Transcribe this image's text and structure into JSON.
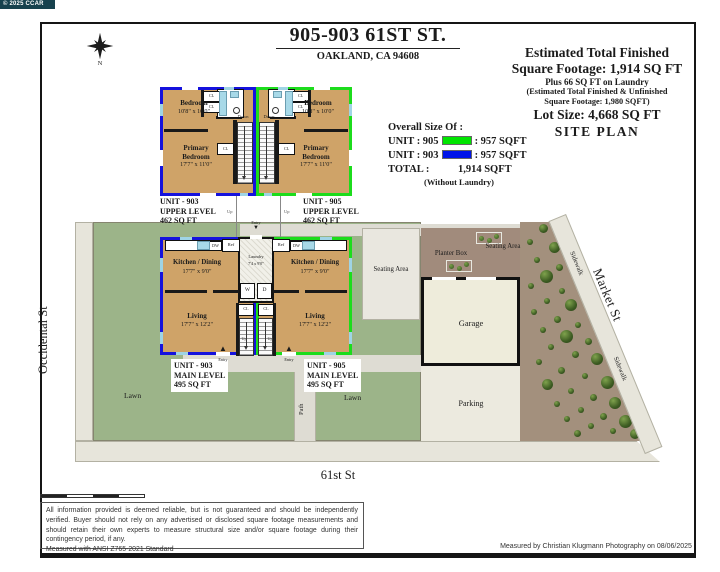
{
  "watermark": "© 2025 CCAR",
  "header": {
    "address": "905-903 61ST ST.",
    "city_line": "OAKLAND, CA 94608"
  },
  "compass_label": "N",
  "summary": {
    "finished_line1": "Estimated Total Finished",
    "finished_line2": "Square Footage: 1,914 SQ FT",
    "laundry_note": "Plus 66 SQ FT on Laundry",
    "unfinished_line1": "(Estimated Total Finished & Unfinished",
    "unfinished_line2": "Square Footage: 1,980 SQFT)",
    "lot_size": "Lot Size:  4,668 SQ FT",
    "site_plan": "SITE PLAN"
  },
  "overall_size": {
    "heading": "Overall Size Of :",
    "rows": [
      {
        "label": "UNIT : 905",
        "swatch": "#00e500",
        "value": ":  957  SQFT"
      },
      {
        "label": "UNIT : 903",
        "swatch": "#0014e8",
        "value": ":  957  SQFT"
      }
    ],
    "total_label": "TOTAL :",
    "total_value": "1,914  SQFT",
    "note": "(Without Laundry)"
  },
  "units": {
    "u903_upper": {
      "l1": "UNIT - 903",
      "l2": "UPPER LEVEL",
      "l3": "462   SQ FT"
    },
    "u905_upper": {
      "l1": "UNIT - 905",
      "l2": "UPPER LEVEL",
      "l3": "462   SQ FT"
    },
    "u903_main": {
      "l1": "UNIT - 903",
      "l2": "MAIN LEVEL",
      "l3": "495   SQ FT"
    },
    "u905_main": {
      "l1": "UNIT - 905",
      "l2": "MAIN LEVEL",
      "l3": "495   SQ FT"
    }
  },
  "rooms": {
    "bedroom": "Bedroom",
    "bedroom_dim": "10'8\" x 10'0\"",
    "primary_l1": "Primary",
    "primary_l2": "Bedroom",
    "primary_dim": "17'7\" x 11'0\"",
    "kitchen": "Kitchen / Dining",
    "kitchen_dim": "17'7\" x 9'0\"",
    "living": "Living",
    "living_dim": "17'7\" x 12'2\"",
    "laundry": "Laundry",
    "laundry_dim": "7'4 x 9'0\"",
    "cl": "CL",
    "w": "W",
    "d": "D",
    "dw": "DW",
    "ref": "Ref",
    "down": "Down",
    "up": "Up",
    "entry": "Entry"
  },
  "site": {
    "occidental_st": "Occidental St",
    "market_st": "Market St",
    "street_61": "61st St",
    "sidewalk": "Sidewalk",
    "lawn": "Lawn",
    "path": "Path",
    "seating_area": "Seating Area",
    "planter_box": "Planter Box",
    "garage": "Garage",
    "parking": "Parking"
  },
  "icons": {
    "arrow_up": "▲",
    "arrow_down": "▼"
  },
  "footer": {
    "disclaimer": "All information provided is deemed reliable, but is not guaranteed and should be independently verified. Buyer should not rely on any advertised or disclosed square footage measurements and should retain their own experts to measure structural size and/or square footage during their contingency period, if any.",
    "standard": "Measured with ANSI Z765-2021 Standard",
    "attribution": "Measured by Christian Klugmann Photography on 08/06/2025"
  },
  "colors": {
    "unit905_green": "#00e500",
    "unit903_blue": "#0014e8",
    "floor_tan": "#cfa368"
  }
}
